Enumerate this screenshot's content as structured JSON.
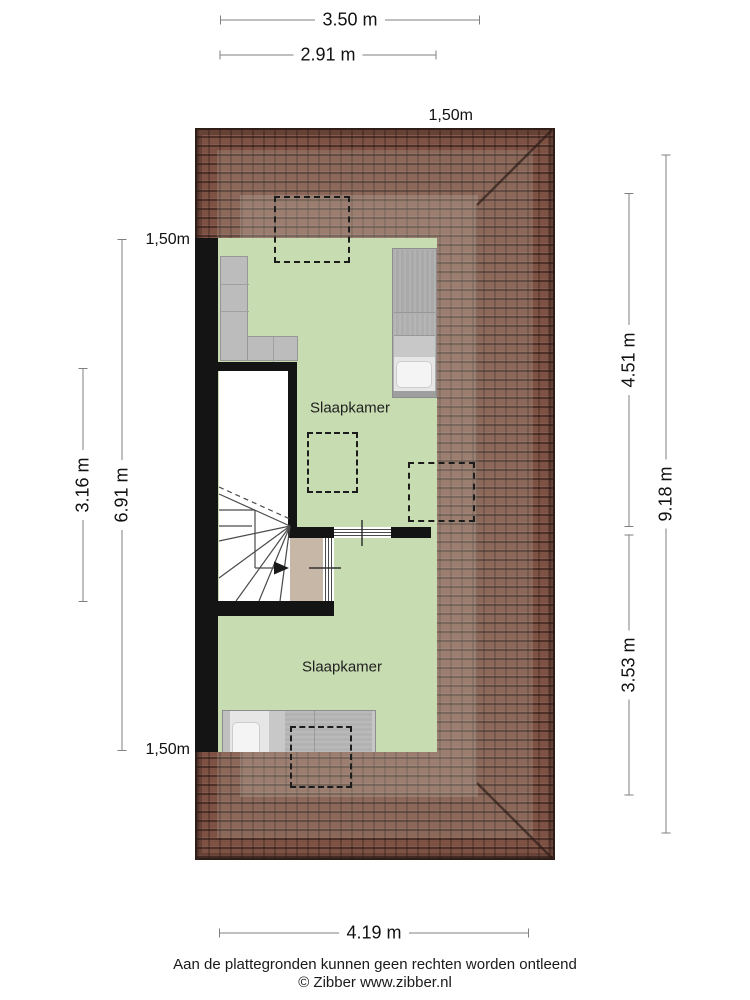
{
  "plan_type": "attic-floor-plan",
  "rooms": [
    {
      "name": "Slaapkamer"
    },
    {
      "name": "Slaapkamer"
    }
  ],
  "dims": {
    "top": [
      "3.50 m",
      "2.91 m"
    ],
    "bottom": [
      "4.19 m"
    ],
    "left": [
      "3.16 m",
      "6.91 m"
    ],
    "right": [
      "4.51 m",
      "3.53 m",
      "9.18 m"
    ]
  },
  "headroom": {
    "top": "1,50m",
    "left_upper": "1,50m",
    "left_lower": "1,50m"
  },
  "footer": {
    "disclaimer": "Aan de plattegronden kunnen geen rechten worden ontleend",
    "copyright": "© Zibber www.zibber.nl"
  },
  "colors": {
    "floor": "#c8dcb2",
    "roof": "#7d5244",
    "roof_edge": "#2f1d17",
    "wall": "#141414",
    "landing": "#c6b7a6",
    "furniture": "#bcbcbc",
    "dashed_outline": "#1c1c1c",
    "dimension_line": "#7f7f7f",
    "text": "#111111"
  }
}
